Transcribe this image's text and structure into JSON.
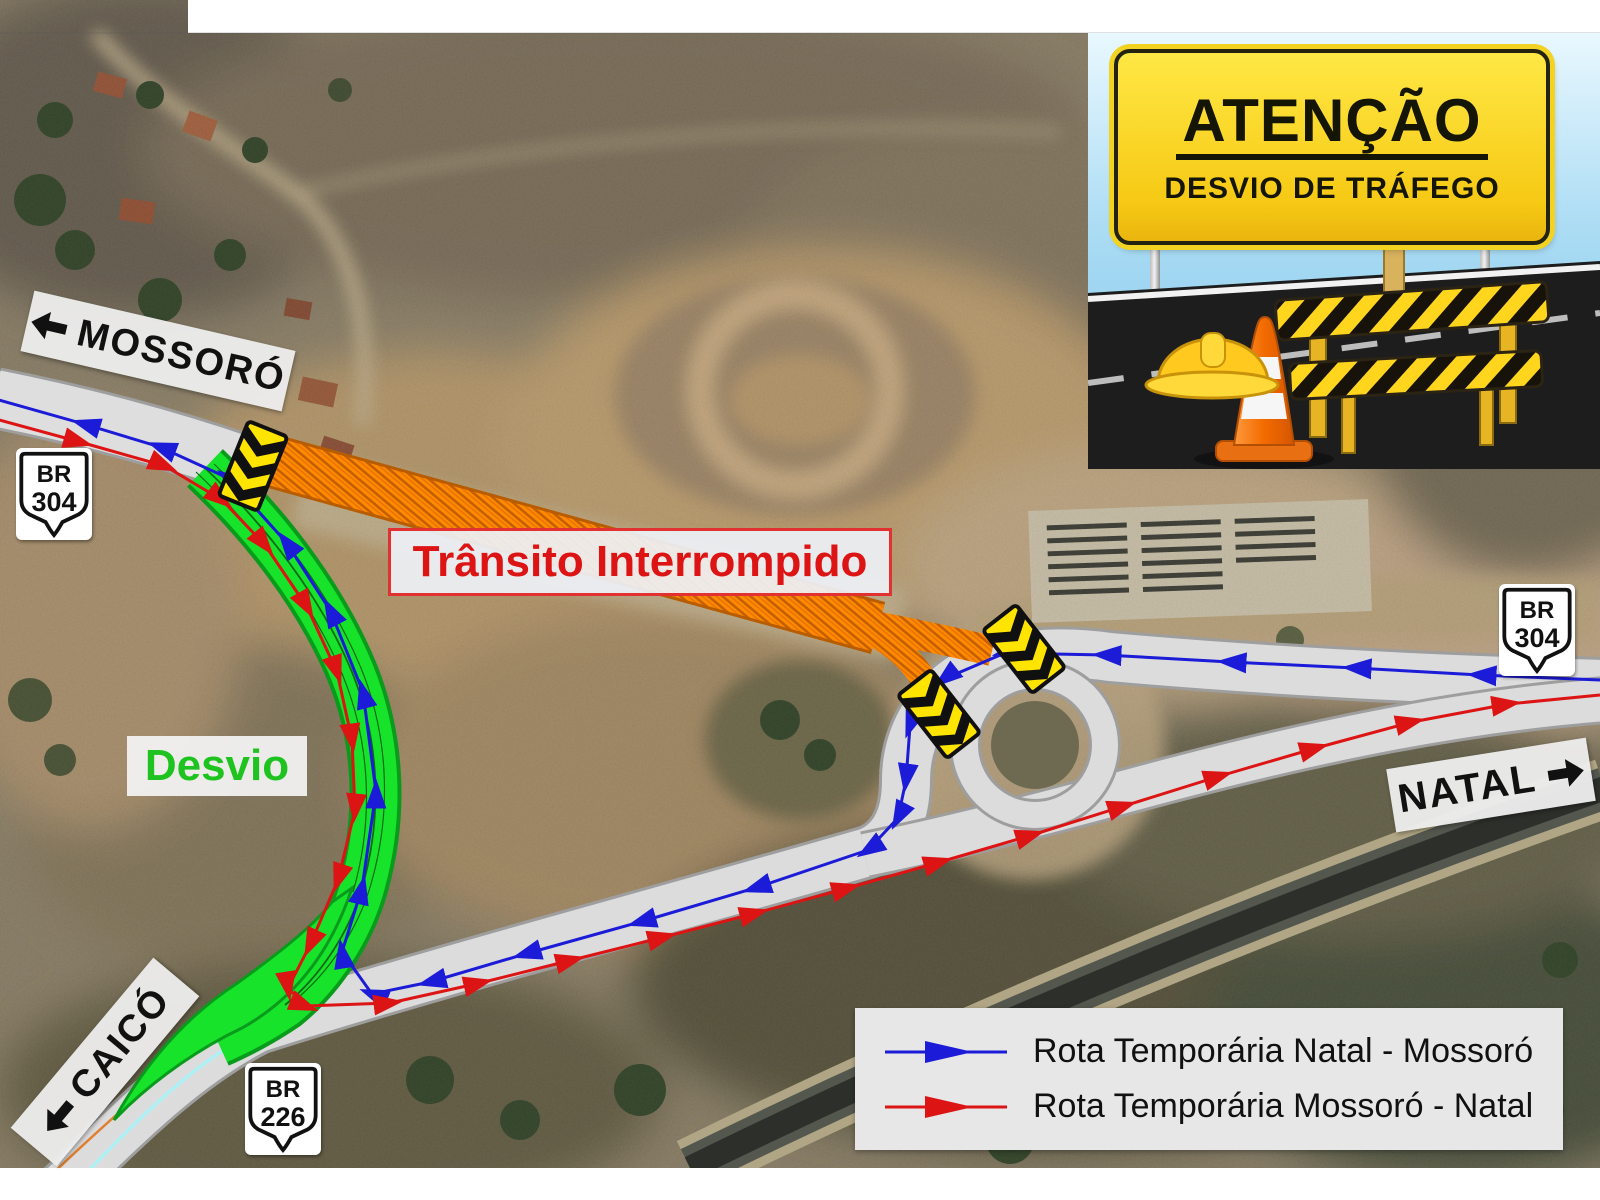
{
  "warning_panel": {
    "title": "ATENÇÃO",
    "subtitle": "DESVIO DE TRÁFEGO"
  },
  "map_labels": {
    "closed": "Trânsito Interrompido",
    "detour": "Desvio",
    "dest_mossoro": "MOSSORÓ",
    "dest_caico": "CAICÓ",
    "dest_natal": "NATAL"
  },
  "shields": [
    {
      "route": "BR",
      "number": "304"
    },
    {
      "route": "BR",
      "number": "304"
    },
    {
      "route": "BR",
      "number": "226"
    }
  ],
  "legend": {
    "items": [
      {
        "color": "#1b1bd8",
        "label": "Rota Temporária Natal - Mossoró"
      },
      {
        "color": "#dd1414",
        "label": "Rota Temporária Mossoró - Natal"
      }
    ]
  },
  "colors": {
    "route_natal_mossoro": "#1b1bd8",
    "route_mossoro_natal": "#dd1414",
    "detour_road": "#17e32b",
    "closed_road": "#ff8a00",
    "barrier_yellow": "#ffe400"
  }
}
